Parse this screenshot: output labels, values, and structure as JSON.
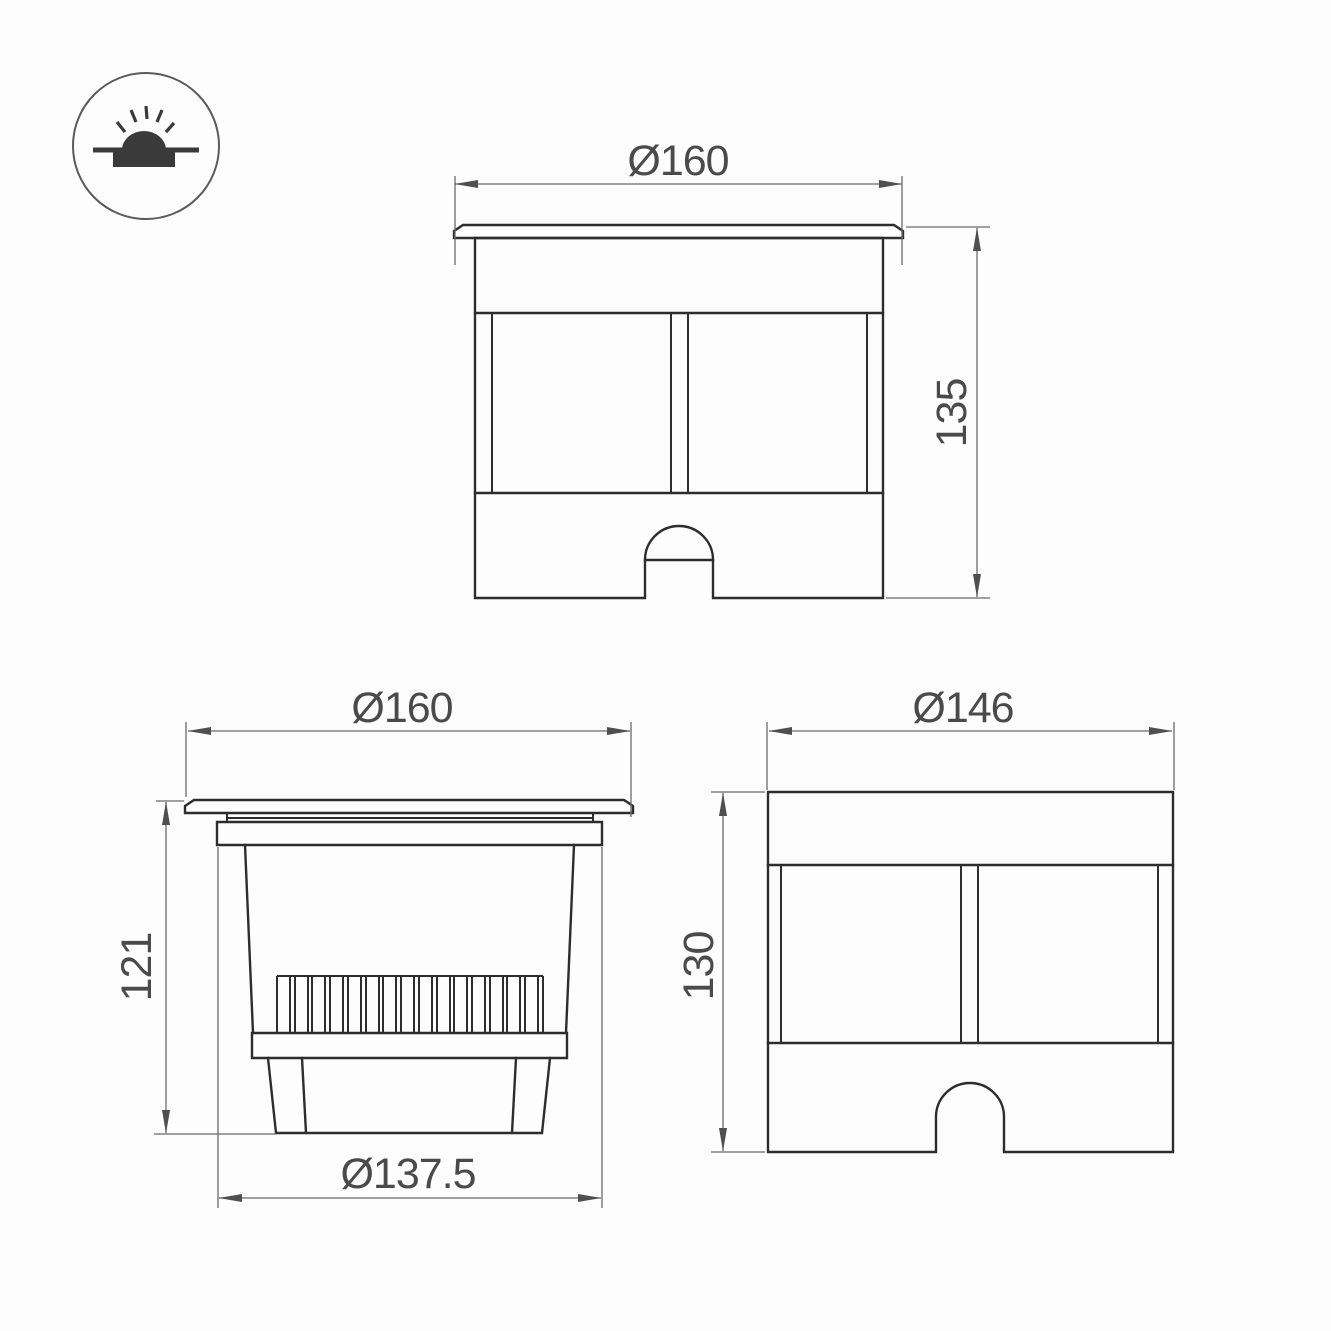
{
  "icon": {
    "name": "recessed-ground-luminaire-symbol"
  },
  "views": {
    "front": {
      "width_label": "Ø160",
      "height_label": "135"
    },
    "side": {
      "width_label": "Ø160",
      "height_label": "121",
      "base_label": "Ø137.5"
    },
    "rear": {
      "width_label": "Ø146",
      "height_label": "130"
    }
  },
  "colors": {
    "object_line": "#2d2d2d",
    "dimension_line": "#6a6a6a",
    "text": "#4a4a4a",
    "background": "#fdfdfd"
  }
}
